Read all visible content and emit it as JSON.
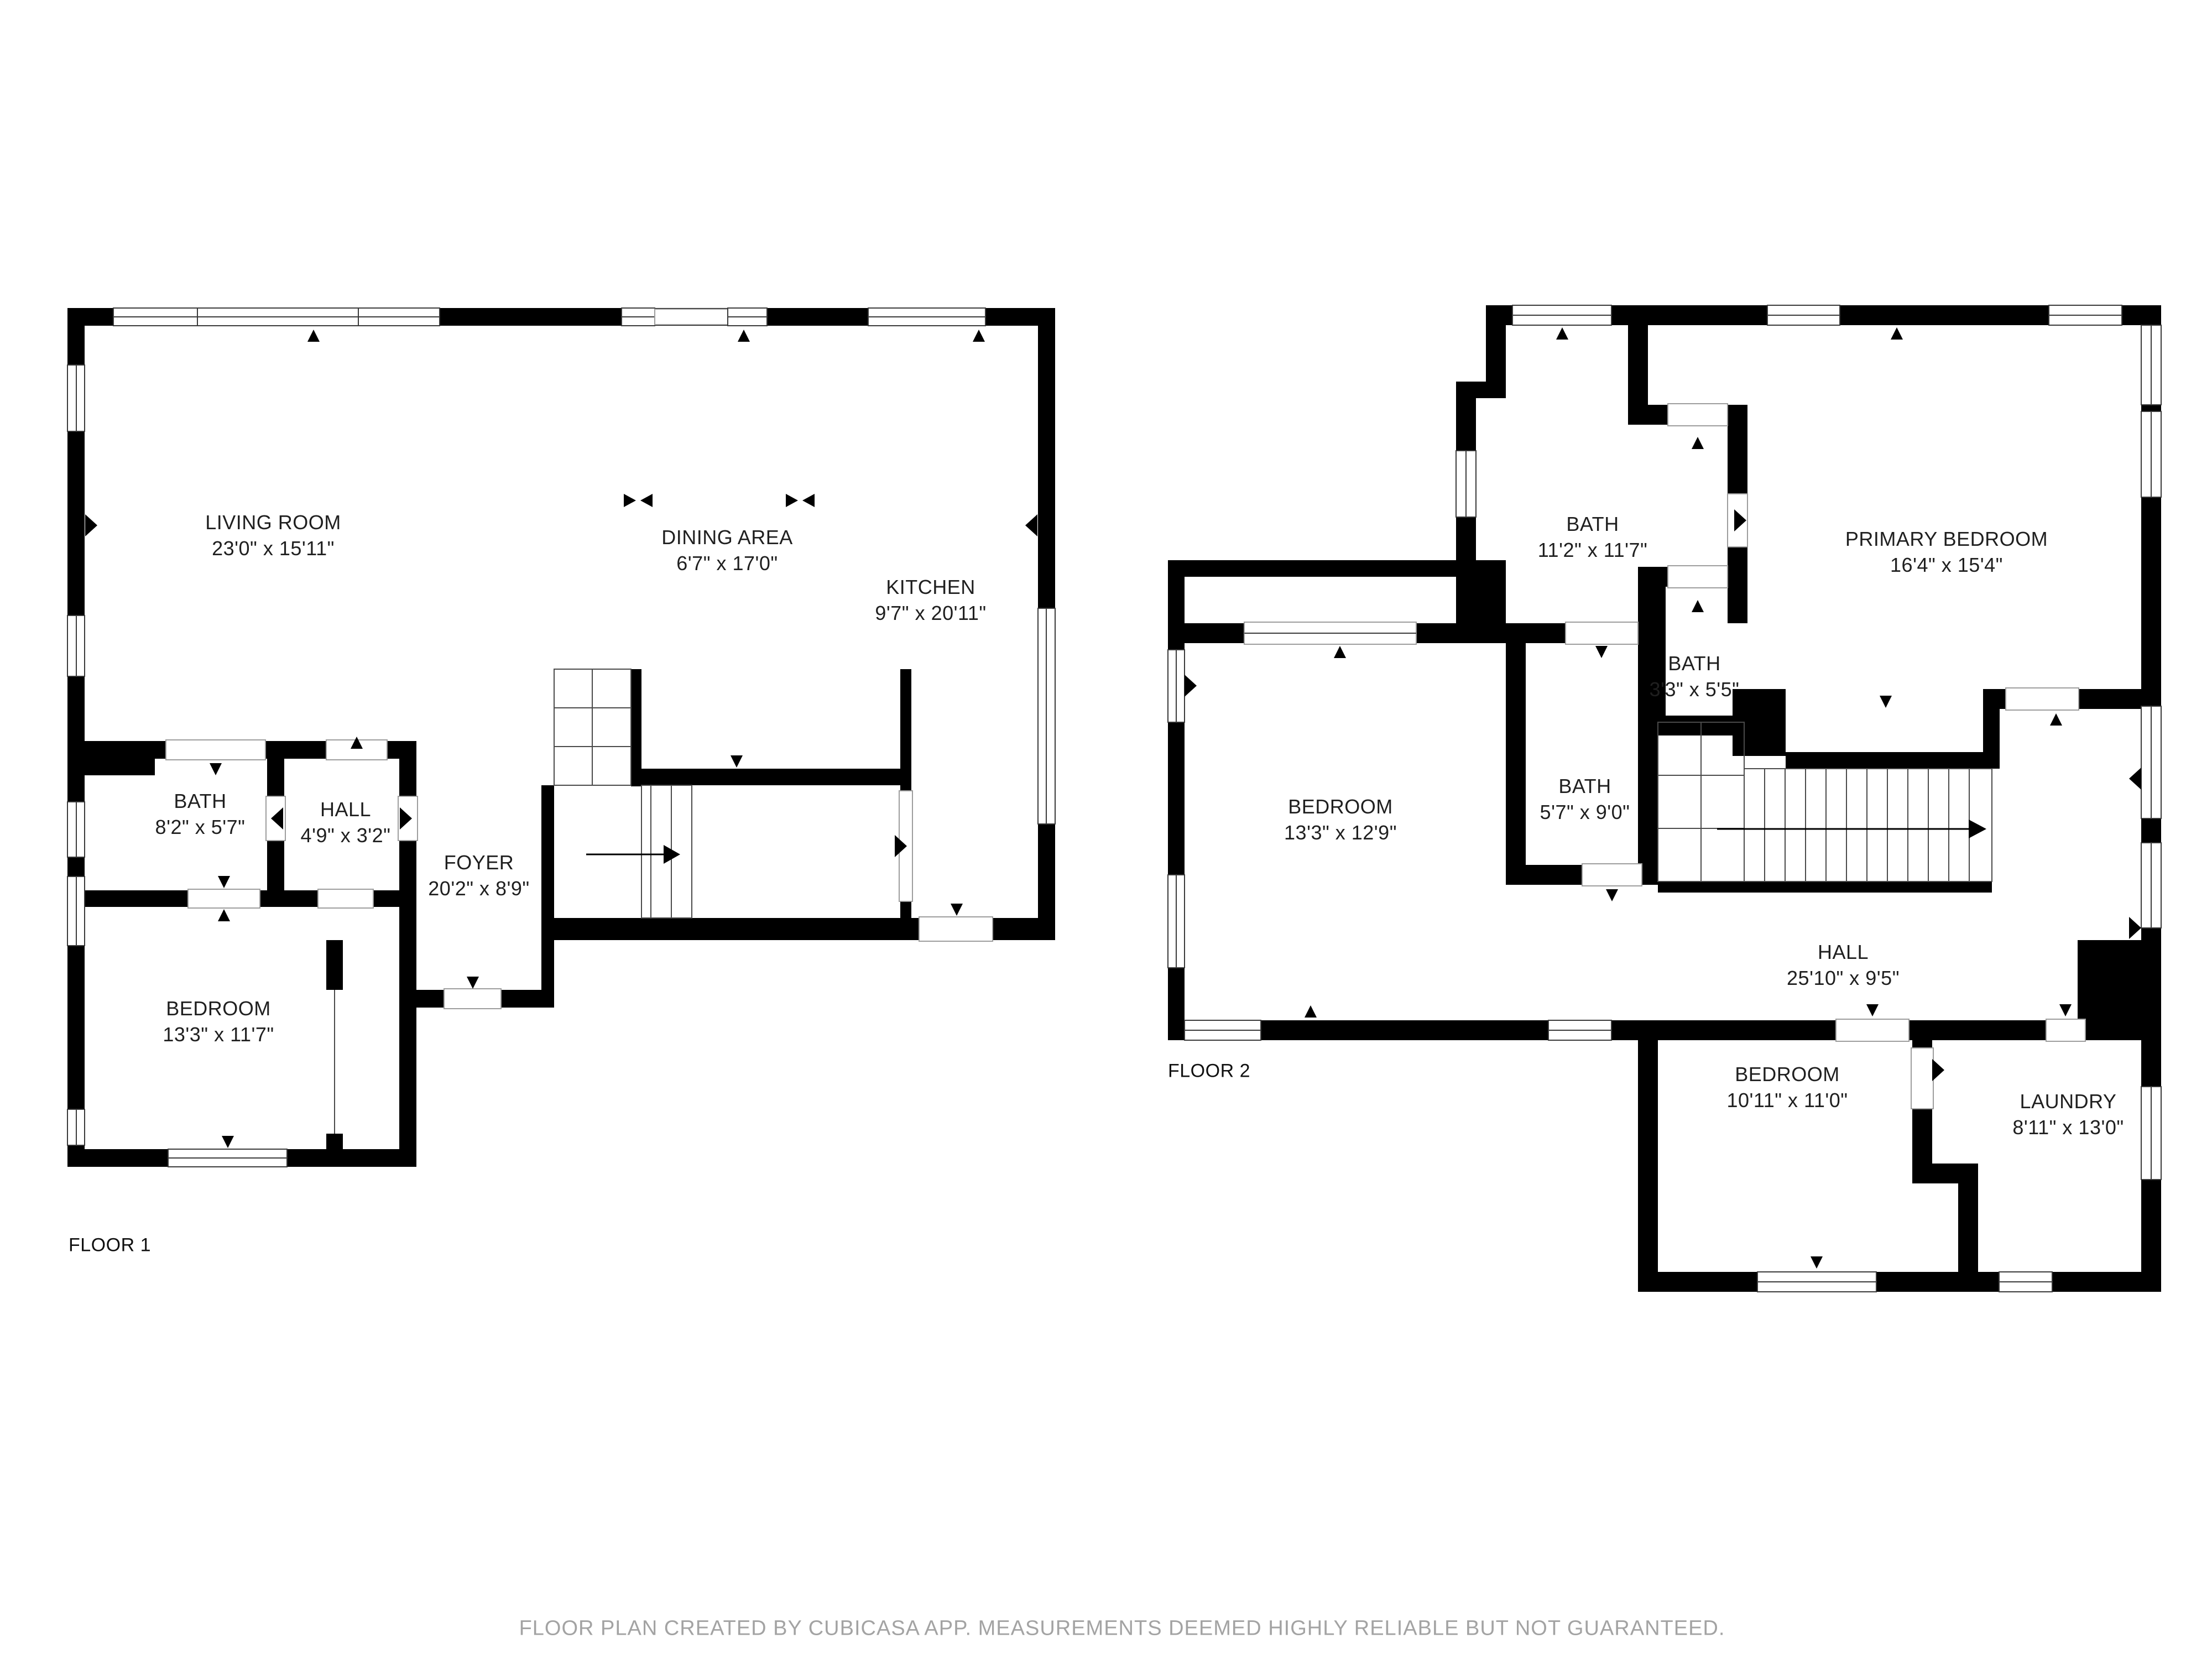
{
  "page": {
    "background_color": "#ffffff",
    "wall_color": "#000000",
    "label_color": "#1f1f1f",
    "disclaimer_color": "#a3a3a3"
  },
  "footer": {
    "disclaimer": "FLOOR PLAN CREATED BY CUBICASA APP. MEASUREMENTS DEEMED HIGHLY RELIABLE BUT NOT GUARANTEED."
  },
  "floor1": {
    "label": "FLOOR 1",
    "rooms": [
      {
        "name": "LIVING ROOM",
        "dims": "23'0\" x 15'11\""
      },
      {
        "name": "DINING AREA",
        "dims": "6'7\" x 17'0\""
      },
      {
        "name": "KITCHEN",
        "dims": "9'7\" x 20'11\""
      },
      {
        "name": "BATH",
        "dims": "8'2\" x 5'7\""
      },
      {
        "name": "HALL",
        "dims": "4'9\" x 3'2\""
      },
      {
        "name": "FOYER",
        "dims": "20'2\" x 8'9\""
      },
      {
        "name": "BEDROOM",
        "dims": "13'3\" x 11'7\""
      }
    ]
  },
  "floor2": {
    "label": "FLOOR 2",
    "rooms": [
      {
        "name": "BATH",
        "dims": "11'2\" x 11'7\""
      },
      {
        "name": "PRIMARY BEDROOM",
        "dims": "16'4\" x 15'4\""
      },
      {
        "name": "BATH",
        "dims": "3'3\" x 5'5\""
      },
      {
        "name": "BEDROOM",
        "dims": "13'3\" x 12'9\""
      },
      {
        "name": "BATH",
        "dims": "5'7\" x 9'0\""
      },
      {
        "name": "HALL",
        "dims": "25'10\" x 9'5\""
      },
      {
        "name": "BEDROOM",
        "dims": "10'11\" x 11'0\""
      },
      {
        "name": "LAUNDRY",
        "dims": "8'11\" x 13'0\""
      }
    ]
  }
}
